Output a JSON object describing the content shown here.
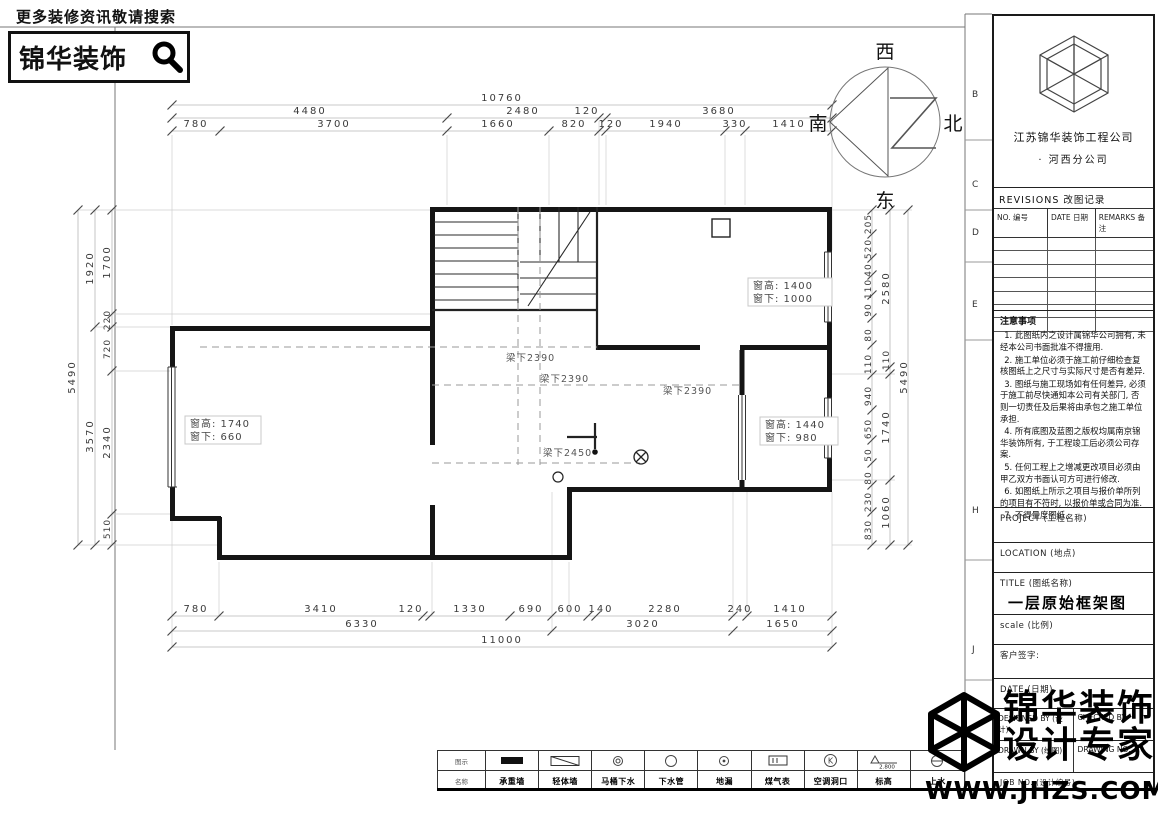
{
  "header": {
    "tagline": "更多装修资讯敬请搜索",
    "brand": "锦华装饰"
  },
  "compass": {
    "west": "西",
    "north": "北",
    "east": "东",
    "south": "南"
  },
  "sidebar": {
    "company_name": "江苏锦华装饰工程公司",
    "company_branch": "·    河西分公司",
    "revisions_title": "REVISIONS 改图记录",
    "revisions_cols": [
      "NO. 编号",
      "DATE 日期",
      "REMARKS 备注"
    ],
    "notes_title": "注意事项",
    "notes": [
      "1. 此图纸内之设计属锦华公司拥有, 未经本公司书面批准不得擅用.",
      "2. 施工单位必须于施工前仔细检查复核图纸上之尺寸与实际尺寸是否有差异.",
      "3. 图纸与施工现场如有任何差异, 必须于施工前尽快通知本公司有关部门, 否则一切责任及后果将由承包之施工单位承担.",
      "4. 所有底图及蓝图之版权均属南京锦华装饰所有, 于工程竣工后必须公司存案.",
      "5. 任何工程上之增减更改项目必须由甲乙双方书面认可方可进行修改.",
      "6. 如图纸上所示之项目与报价单所列的项目有不符时, 以报价单或合同为准.",
      "7. 不得量度图纸."
    ],
    "project_label": "PROJECT (工程名称)",
    "location_label": "LOCATION (地点)",
    "title_label": "TITLE (图纸名称)",
    "drawing_title": "一层原始框架图",
    "scale_label": "scale  (比例)",
    "client_sign_label": "客户签字:",
    "date_label": "DATE (日期)",
    "designed_by": "DESIGNED BY (设计)",
    "checked_by": "CHECKED BY",
    "drawn_by": "DRAWN BY (绘图)",
    "drawing_no": "DRAWING NO.",
    "job_no": "JOB NO. (设计编号)"
  },
  "grid_letters": [
    "B",
    "C",
    "D",
    "E",
    "H",
    "J"
  ],
  "watermark": {
    "line1": "锦华装饰",
    "line2": "设计专家",
    "url": "WWW.JHZS.COM"
  },
  "dims": {
    "top_row1": [
      "10760"
    ],
    "top_row2": [
      "4480",
      "2480",
      "120",
      "3680"
    ],
    "top_row3": [
      "780",
      "3700",
      "1660",
      "820",
      "120",
      "1940",
      "330",
      "1410"
    ],
    "bottom_row1": [
      "780",
      "3410",
      "120",
      "1330",
      "690",
      "600",
      "140",
      "2280",
      "240",
      "1410"
    ],
    "bottom_row2": [
      "6330",
      "3020",
      "1650"
    ],
    "bottom_row3": [
      "11000"
    ],
    "left_outer": [
      "5490"
    ],
    "left_mid": [
      "1920",
      "3570"
    ],
    "left_inner": [
      "1700",
      "220",
      "720",
      "2340",
      "510"
    ],
    "right_outer": [
      "5490"
    ],
    "right_mid": [
      "2580",
      "110",
      "1740",
      "1060"
    ],
    "right_inner": [
      "205",
      "520",
      "40",
      "110",
      "90",
      "80",
      "110",
      "940",
      "650",
      "50",
      "80",
      "230",
      "830"
    ]
  },
  "plan": {
    "win_top_right": {
      "l1": "窗高: 1400",
      "l2": "窗下: 1000"
    },
    "win_left": {
      "l1": "窗高: 1740",
      "l2": "窗下: 660"
    },
    "win_bottom_right": {
      "l1": "窗高: 1440",
      "l2": "窗下: 980"
    },
    "beam1": "梁下2390",
    "beam2": "梁下2390",
    "beam3": "梁下2390",
    "beam4": "梁下2450"
  },
  "legend": {
    "row_symbol_label": "图示",
    "row_name_label": "名称",
    "elevation_value": "2.800",
    "items": [
      {
        "label": "承重墙"
      },
      {
        "label": "轻体墙"
      },
      {
        "label": "马桶下水"
      },
      {
        "label": "下水管"
      },
      {
        "label": "地漏"
      },
      {
        "label": "煤气表"
      },
      {
        "label": "空调洞口"
      },
      {
        "label": "标高"
      },
      {
        "label": "上水"
      }
    ]
  }
}
